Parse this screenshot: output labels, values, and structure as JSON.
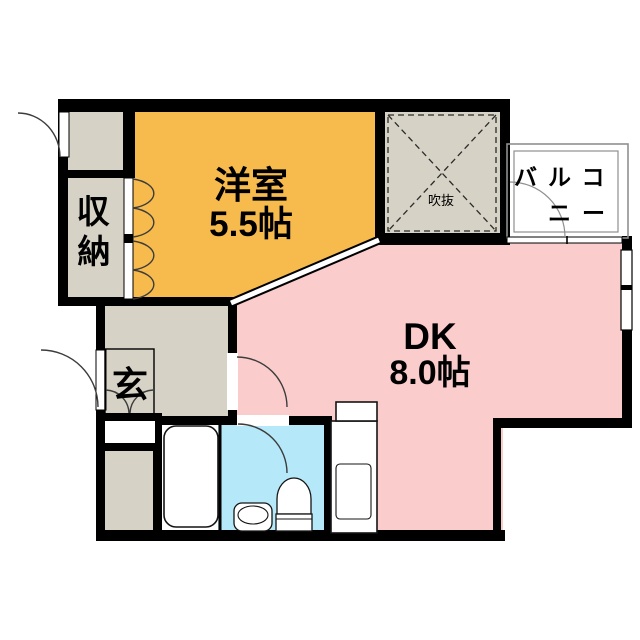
{
  "plan": {
    "rooms": {
      "western_room": {
        "label": "洋室",
        "size": "5.5帖",
        "color": "#F7BA4D"
      },
      "dk": {
        "label": "DK",
        "size": "8.0帖",
        "color": "#FACCCC"
      },
      "closet": {
        "char1": "収",
        "char2": "納",
        "color": "#D6D2C5"
      },
      "entrance": {
        "label": "玄",
        "color": "#D6D2C5"
      },
      "void_space": {
        "label": "吹抜",
        "color": "#D6D2C5"
      },
      "balcony": {
        "line1": "バルコ",
        "line2": "ニー",
        "color": "#FFFFFF"
      },
      "toilet_room": {
        "color": "#B5E8F8"
      },
      "bathroom": {
        "color": "#FFFFFF"
      },
      "washroom": {
        "color": "#D6D2C5"
      },
      "porch": {
        "color": "#D6D2C5"
      },
      "hallway": {
        "color": "#D6D2C5"
      }
    },
    "colors": {
      "wall": "#000000",
      "background": "#FFFFFF",
      "balcony_line": "#8F8F8F",
      "gap_white": "#FFFFFF"
    }
  }
}
